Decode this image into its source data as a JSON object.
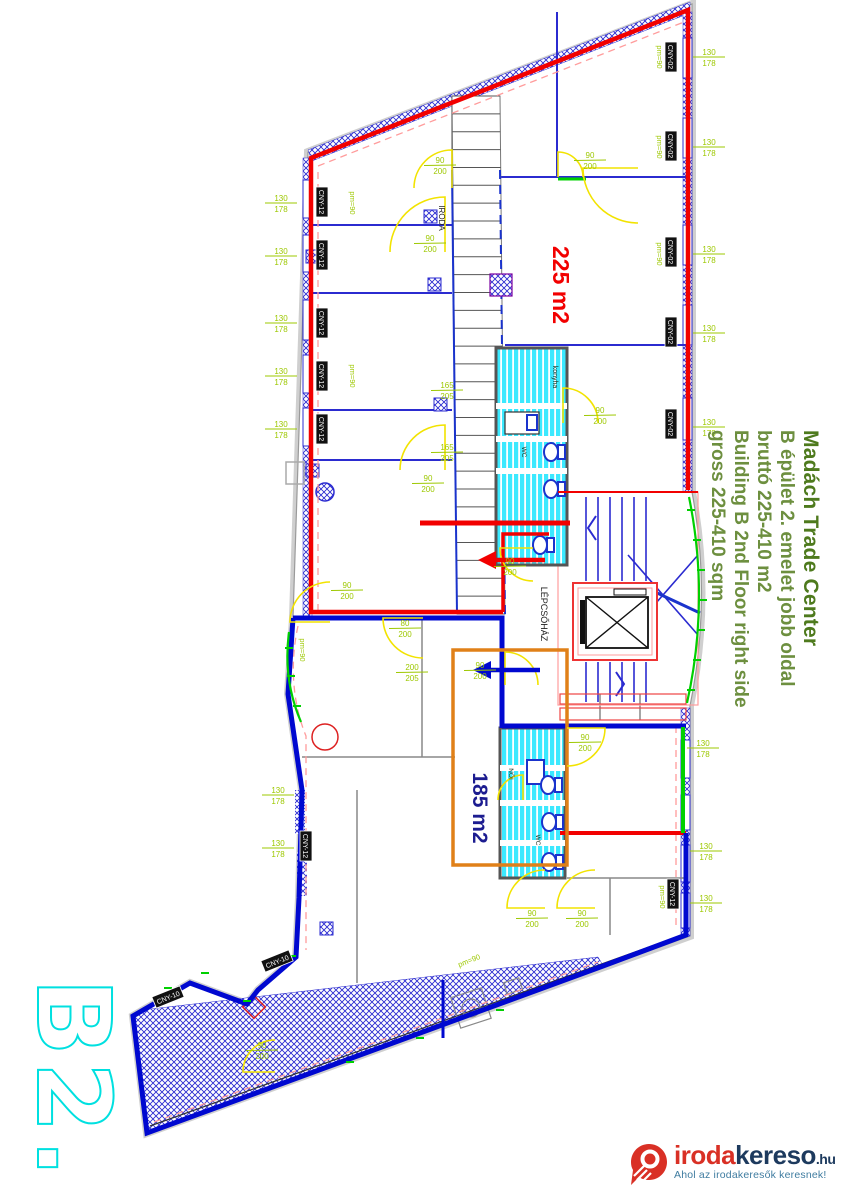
{
  "watermark": "B2.",
  "areas": {
    "area1": "225 m2",
    "area2": "185 m2"
  },
  "rooms": {
    "stairwell": "LÉPCSŐHÁZ",
    "office": "IRODA",
    "kitchen": "konyha",
    "wc": "WC",
    "women": "NŐI"
  },
  "info_panel": {
    "title": "Madách Trade Center",
    "lines": [
      "B épület 2. emelet jobb oldal",
      "bruttó 225-410 m2",
      "Building B 2nd Floor right side",
      "gross 225-410 sqm"
    ]
  },
  "dims": {
    "window": {
      "w": "130",
      "h": "178"
    },
    "door": {
      "w": "90",
      "h": "200"
    },
    "door2": {
      "w": "165",
      "h": "205"
    },
    "door3": {
      "w": "200",
      "h": "205"
    },
    "door4": {
      "w": "80",
      "h": "200"
    }
  },
  "window_labels": {
    "a": "CNY-02",
    "b": "CNY-12",
    "c": "CNY-10"
  },
  "annotations": {
    "pm": "pm=90"
  },
  "logo": {
    "name_red": "iroda",
    "name_blue": "kereso",
    "tld": ".hu",
    "tagline": "Ahol az irodakeresők keresnek!"
  },
  "colors": {
    "area1_outline": "#f20000",
    "area2_outline": "#0008d0",
    "corridor_outline": "#e08018",
    "dimension_text": "#9dc800",
    "facade_marks": "#00d000",
    "bathroom_fill": "#3be9ff",
    "door_arcs": "#f2e300",
    "info_title": "#4e7a1d",
    "info_body": "#6d8f3f",
    "watermark": "#00e0e0",
    "logo_red": "#d93025",
    "logo_navy": "#1d3a5e",
    "logo_teal": "#3f7ca0"
  }
}
